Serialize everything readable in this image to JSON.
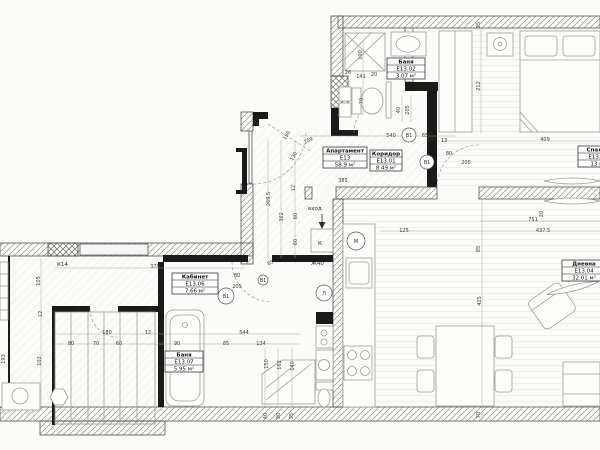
{
  "apartment": {
    "label": "Апартамент Е13",
    "area": "58.9 м²"
  },
  "rooms": [
    {
      "name": "Апартамент",
      "code": "Е13",
      "area": "58.9 м²",
      "x": 323,
      "y": 147,
      "w": 44
    },
    {
      "name": "Коридор",
      "code": "Е13.01",
      "area": "8.49 м²",
      "x": 370,
      "y": 150,
      "w": 32
    },
    {
      "name": "Баня",
      "code": "Е13.02",
      "area": "3.07 м²",
      "x": 387,
      "y": 58,
      "w": 38
    },
    {
      "name": "Спалня",
      "code": "Е13.03",
      "area": "13 м²",
      "x": 578,
      "y": 146,
      "w": 40
    },
    {
      "name": "Дневна",
      "code": "Е13.04",
      "area": "32.01 м²",
      "x": 562,
      "y": 260,
      "w": 44
    },
    {
      "name": "Кабинет",
      "code": "Е13.06",
      "area": "7.66 м²",
      "x": 172,
      "y": 273,
      "w": 46
    },
    {
      "name": "Баня",
      "code": "Е13.07",
      "area": "5.95 м²",
      "x": 165,
      "y": 351,
      "w": 38
    }
  ],
  "door_tags": [
    {
      "t": "В1",
      "x": 409,
      "y": 135,
      "r": 7
    },
    {
      "t": "В1",
      "x": 427,
      "y": 162,
      "r": 7
    },
    {
      "t": "В1",
      "x": 226,
      "y": 296,
      "r": 8
    },
    {
      "t": "В1",
      "x": 263,
      "y": 280,
      "r": 5
    },
    {
      "t": "М",
      "x": 356,
      "y": 241,
      "r": 9
    },
    {
      "t": "Л",
      "x": 324,
      "y": 293,
      "r": 8
    }
  ],
  "annotations": [
    {
      "t": "вход",
      "x": 308,
      "y": 210
    },
    {
      "t": "Ж40",
      "x": 311,
      "y": 265
    },
    {
      "t": "К14",
      "x": 57,
      "y": 266
    },
    {
      "t": "К",
      "x": 318,
      "y": 245
    }
  ],
  "dimensions": [
    {
      "t": "385",
      "x": 343,
      "y": 182,
      "r": 0
    },
    {
      "t": "540",
      "x": 391,
      "y": 137,
      "r": 0
    },
    {
      "t": "65",
      "x": 425,
      "y": 137,
      "r": 0
    },
    {
      "t": "109",
      "x": 309,
      "y": 142,
      "r": -25
    },
    {
      "t": "10",
      "x": 431,
      "y": 141,
      "r": -20
    },
    {
      "t": "13",
      "x": 444,
      "y": 142,
      "r": 0
    },
    {
      "t": "25",
      "x": 480,
      "y": 25,
      "r": -90
    },
    {
      "t": "212",
      "x": 480,
      "y": 86,
      "r": -90
    },
    {
      "t": "409",
      "x": 545,
      "y": 141,
      "r": 0
    },
    {
      "t": "26",
      "x": 348,
      "y": 74,
      "r": 0
    },
    {
      "t": "141",
      "x": 361,
      "y": 78,
      "r": 0
    },
    {
      "t": "20",
      "x": 374,
      "y": 76,
      "r": 0
    },
    {
      "t": "100",
      "x": 362,
      "y": 55,
      "r": -90
    },
    {
      "t": "70",
      "x": 363,
      "y": 101,
      "r": -90
    },
    {
      "t": "40",
      "x": 400,
      "y": 110,
      "r": -90
    },
    {
      "t": "205",
      "x": 409,
      "y": 110,
      "r": -90
    },
    {
      "t": "25",
      "x": 258,
      "y": 122,
      "r": -90
    },
    {
      "t": "150",
      "x": 288,
      "y": 136,
      "r": -60
    },
    {
      "t": "130",
      "x": 295,
      "y": 157,
      "r": -60
    },
    {
      "t": "269.5",
      "x": 270,
      "y": 199,
      "r": -90
    },
    {
      "t": "362",
      "x": 283,
      "y": 217,
      "r": -90
    },
    {
      "t": "12",
      "x": 295,
      "y": 188,
      "r": -90
    },
    {
      "t": "60",
      "x": 297,
      "y": 216,
      "r": -90
    },
    {
      "t": "60",
      "x": 297,
      "y": 242,
      "r": -90
    },
    {
      "t": "85",
      "x": 271,
      "y": 264,
      "r": -25
    },
    {
      "t": "80",
      "x": 449,
      "y": 155,
      "r": 0
    },
    {
      "t": "205",
      "x": 466,
      "y": 164,
      "r": 0
    },
    {
      "t": "80",
      "x": 237,
      "y": 277,
      "r": 0
    },
    {
      "t": "205",
      "x": 237,
      "y": 288,
      "r": 0
    },
    {
      "t": "379",
      "x": 155,
      "y": 268,
      "r": 0
    },
    {
      "t": "105",
      "x": 40,
      "y": 281,
      "r": -90
    },
    {
      "t": "12",
      "x": 42,
      "y": 314,
      "r": -90
    },
    {
      "t": "102",
      "x": 41,
      "y": 361,
      "r": -90
    },
    {
      "t": "193",
      "x": 5,
      "y": 359,
      "r": -90
    },
    {
      "t": "180",
      "x": 107,
      "y": 334,
      "r": 0
    },
    {
      "t": "12",
      "x": 148,
      "y": 334,
      "r": 0
    },
    {
      "t": "544",
      "x": 244,
      "y": 334,
      "r": 0
    },
    {
      "t": "80",
      "x": 71,
      "y": 345,
      "r": 0
    },
    {
      "t": "70",
      "x": 96,
      "y": 345,
      "r": 0
    },
    {
      "t": "60",
      "x": 119,
      "y": 345,
      "r": 0
    },
    {
      "t": "12",
      "x": 160,
      "y": 345,
      "r": 0
    },
    {
      "t": "90",
      "x": 177,
      "y": 345,
      "r": 0
    },
    {
      "t": "85",
      "x": 226,
      "y": 345,
      "r": 0
    },
    {
      "t": "134",
      "x": 261,
      "y": 345,
      "r": 0
    },
    {
      "t": "150",
      "x": 268,
      "y": 364,
      "r": -90
    },
    {
      "t": "162",
      "x": 281,
      "y": 365,
      "r": -90
    },
    {
      "t": "140",
      "x": 294,
      "y": 366,
      "r": -90
    },
    {
      "t": "40",
      "x": 267,
      "y": 416,
      "r": -90
    },
    {
      "t": "90",
      "x": 280,
      "y": 416,
      "r": -90
    },
    {
      "t": "35",
      "x": 293,
      "y": 416,
      "r": -90
    },
    {
      "t": "125",
      "x": 404,
      "y": 232,
      "r": 0
    },
    {
      "t": "437.5",
      "x": 543,
      "y": 232,
      "r": 0
    },
    {
      "t": "751",
      "x": 533,
      "y": 221,
      "r": 0
    },
    {
      "t": "20",
      "x": 543,
      "y": 214,
      "r": -90
    },
    {
      "t": "85",
      "x": 480,
      "y": 249,
      "r": -90
    },
    {
      "t": "425",
      "x": 481,
      "y": 301,
      "r": -90
    },
    {
      "t": "70",
      "x": 480,
      "y": 415,
      "r": -90
    }
  ]
}
